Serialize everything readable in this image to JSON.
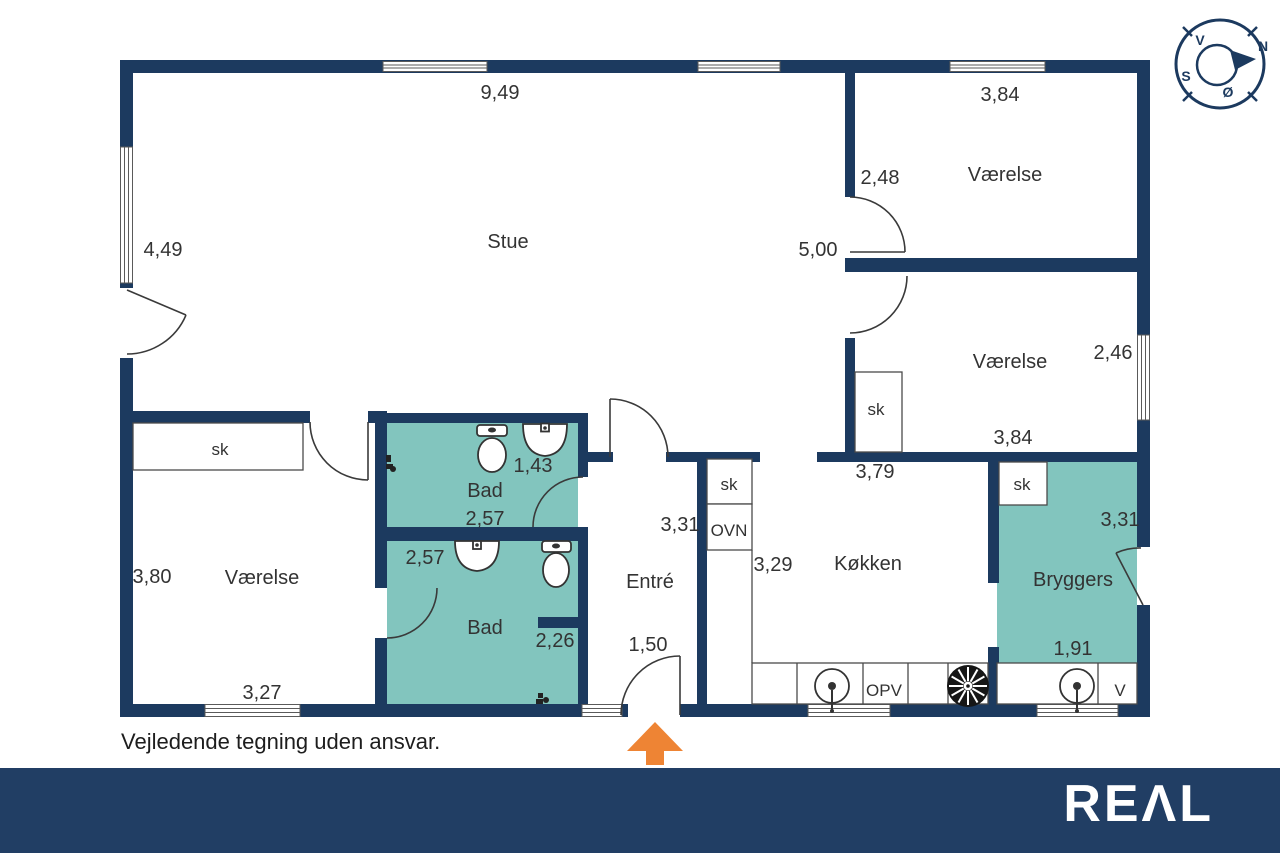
{
  "colors": {
    "wall": "#1c3a5f",
    "bath_floor": "#82c5be",
    "arrow": "#ee8434",
    "footer_bar": "#213e64",
    "text": "#333333"
  },
  "footer": {
    "disclaimer": "Vejledende tegning uden ansvar.",
    "logo_text": "REΛL"
  },
  "compass": {
    "points": [
      {
        "name": "compass-letter-v",
        "text": "V",
        "x": 1200,
        "y": 45
      },
      {
        "name": "compass-letter-n",
        "text": "N",
        "x": 1263,
        "y": 51
      },
      {
        "name": "compass-letter-s",
        "text": "S",
        "x": 1186,
        "y": 81
      },
      {
        "name": "compass-letter-oe",
        "text": "Ø",
        "x": 1228,
        "y": 97
      }
    ]
  },
  "plan": {
    "labels": [
      {
        "cls": "lbl-room",
        "name": "room-label-stue",
        "text": "Stue",
        "x": 508,
        "y": 248
      },
      {
        "cls": "lbl-room",
        "name": "room-label-vaerelse-topright",
        "text": "Værelse",
        "x": 1005,
        "y": 181
      },
      {
        "cls": "lbl-room",
        "name": "room-label-vaerelse-midright",
        "text": "Værelse",
        "x": 1010,
        "y": 368
      },
      {
        "cls": "lbl-room",
        "name": "room-label-vaerelse-bottomleft",
        "text": "Værelse",
        "x": 262,
        "y": 584
      },
      {
        "cls": "lbl-room",
        "name": "room-label-bad-1",
        "text": "Bad",
        "x": 485,
        "y": 497
      },
      {
        "cls": "lbl-room",
        "name": "room-label-bad-2",
        "text": "Bad",
        "x": 485,
        "y": 634
      },
      {
        "cls": "lbl-room",
        "name": "room-label-entre",
        "text": "Entré",
        "x": 650,
        "y": 588
      },
      {
        "cls": "lbl-room",
        "name": "room-label-koekken",
        "text": "Køkken",
        "x": 868,
        "y": 570
      },
      {
        "cls": "lbl-room",
        "name": "room-label-bryggers",
        "text": "Bryggers",
        "x": 1073,
        "y": 586
      },
      {
        "cls": "lbl-dim",
        "name": "dim-stue-width",
        "text": "9,49",
        "x": 500,
        "y": 99
      },
      {
        "cls": "lbl-dim",
        "name": "dim-vaerelse-tr-width",
        "text": "3,84",
        "x": 1000,
        "y": 101
      },
      {
        "cls": "lbl-dim",
        "name": "dim-stue-left-height",
        "text": "4,49",
        "x": 163,
        "y": 256
      },
      {
        "cls": "lbl-dim",
        "name": "dim-vaerelse-tr-height",
        "text": "2,48",
        "x": 880,
        "y": 184
      },
      {
        "cls": "lbl-dim",
        "name": "dim-stue-right-height",
        "text": "5,00",
        "x": 818,
        "y": 256
      },
      {
        "cls": "lbl-dim",
        "name": "dim-vaerelse-mr-height",
        "text": "2,46",
        "x": 1113,
        "y": 359
      },
      {
        "cls": "lbl-dim",
        "name": "dim-vaerelse-mr-width",
        "text": "3,84",
        "x": 1013,
        "y": 444
      },
      {
        "cls": "lbl-dim",
        "name": "dim-bad1-height",
        "text": "1,43",
        "x": 533,
        "y": 472
      },
      {
        "cls": "lbl-dim",
        "name": "dim-bad1-width",
        "text": "2,57",
        "x": 485,
        "y": 525
      },
      {
        "cls": "lbl-dim",
        "name": "dim-bad2-width",
        "text": "2,57",
        "x": 425,
        "y": 564
      },
      {
        "cls": "lbl-dim",
        "name": "dim-entre-height",
        "text": "3,31",
        "x": 680,
        "y": 531
      },
      {
        "cls": "lbl-dim",
        "name": "dim-koekken-width",
        "text": "3,79",
        "x": 875,
        "y": 478
      },
      {
        "cls": "lbl-dim",
        "name": "dim-bryggers-height",
        "text": "3,31",
        "x": 1120,
        "y": 526
      },
      {
        "cls": "lbl-dim",
        "name": "dim-vaerelse-bl-height",
        "text": "3,80",
        "x": 152,
        "y": 583
      },
      {
        "cls": "lbl-dim",
        "name": "dim-koekken-height",
        "text": "3,29",
        "x": 773,
        "y": 571
      },
      {
        "cls": "lbl-dim",
        "name": "dim-bad2-height",
        "text": "2,26",
        "x": 555,
        "y": 647
      },
      {
        "cls": "lbl-dim",
        "name": "dim-entre-width",
        "text": "1,50",
        "x": 648,
        "y": 651
      },
      {
        "cls": "lbl-dim",
        "name": "dim-vaerelse-bl-width",
        "text": "3,27",
        "x": 262,
        "y": 699
      },
      {
        "cls": "lbl-dim",
        "name": "dim-bryggers-width",
        "text": "1,91",
        "x": 1073,
        "y": 655
      },
      {
        "cls": "lbl-feat",
        "name": "closet-label-vaerelse-bl",
        "text": "sk",
        "x": 220,
        "y": 455
      },
      {
        "cls": "lbl-feat",
        "name": "closet-label-entre",
        "text": "sk",
        "x": 729,
        "y": 490
      },
      {
        "cls": "lbl-feat",
        "name": "oven-label",
        "text": "OVN",
        "x": 729,
        "y": 536
      },
      {
        "cls": "lbl-feat",
        "name": "closet-label-vaerelse-mr",
        "text": "sk",
        "x": 876,
        "y": 415
      },
      {
        "cls": "lbl-feat",
        "name": "closet-label-bryggers",
        "text": "sk",
        "x": 1022,
        "y": 490
      },
      {
        "cls": "lbl-feat",
        "name": "dishwasher-label",
        "text": "OPV",
        "x": 884,
        "y": 696
      },
      {
        "cls": "lbl-feat",
        "name": "washer-label",
        "text": "V",
        "x": 1120,
        "y": 696
      }
    ]
  }
}
